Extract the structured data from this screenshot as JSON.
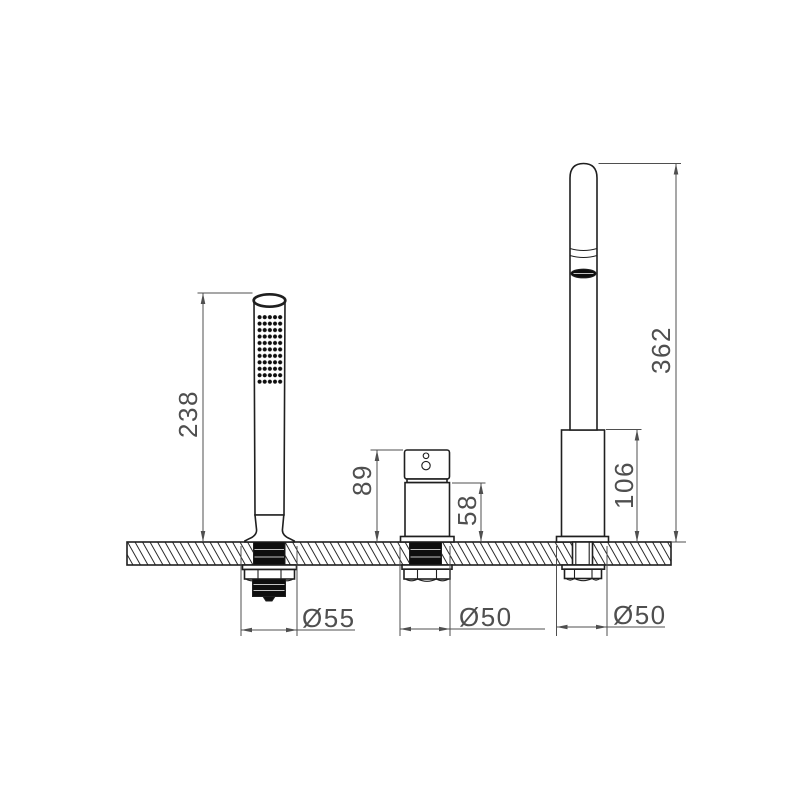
{
  "colors": {
    "outline": "#1f1f1f",
    "dimension": "#4f4f4f",
    "fill-dark": "#0e0e0e",
    "fill-light": "#ffffff",
    "background": "#ffffff"
  },
  "dimensions": {
    "handshower_height": "238",
    "diverter_total_height": "89",
    "diverter_body_height": "58",
    "spout_total_height": "362",
    "spout_base_height": "106",
    "handshower_hole_diameter": "Ø55",
    "diverter_hole_diameter": "Ø50",
    "spout_hole_diameter": "Ø50"
  }
}
